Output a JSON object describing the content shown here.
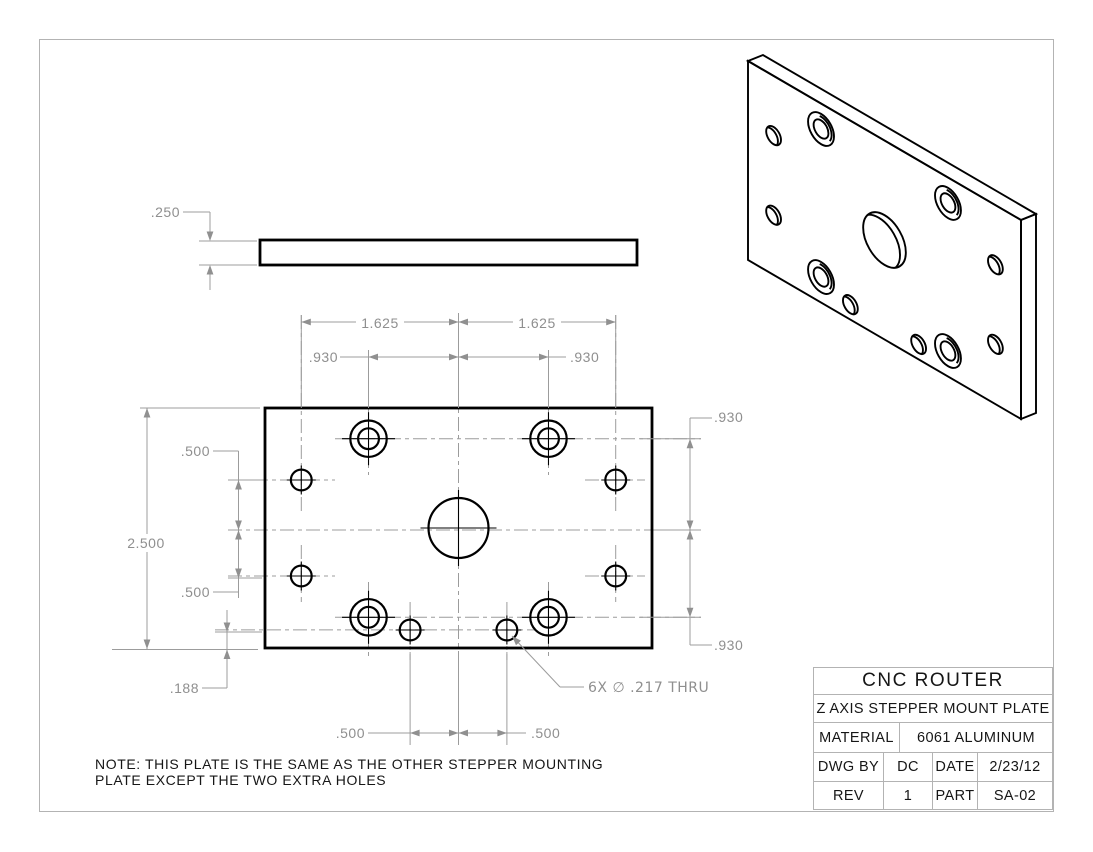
{
  "title_block": {
    "title": "CNC ROUTER",
    "subtitle": "Z AXIS STEPPER MOUNT PLATE",
    "material_label": "MATERIAL",
    "material_value": "6061 ALUMINUM",
    "dwg_by_label": "DWG BY",
    "dwg_by_value": "DC",
    "date_label": "DATE",
    "date_value": "2/23/12",
    "rev_label": "REV",
    "rev_value": "1",
    "part_label": "PART",
    "part_value": "SA-02"
  },
  "note": {
    "line1": "NOTE: THIS PLATE IS THE SAME AS THE OTHER STEPPER MOUNTING",
    "line2": "PLATE EXCEPT THE TWO EXTRA HOLES"
  },
  "dimensions": {
    "side_thickness": ".250",
    "top_left_1625": "1.625",
    "top_right_1625": "1.625",
    "upper_left_930": ".930",
    "upper_right_930": ".930",
    "right_top_930": ".930",
    "right_bottom_930": ".930",
    "left_top_500": ".500",
    "overall_height": "2.500",
    "left_bottom_500": ".500",
    "bottom_offset_188": ".188",
    "bottom_left_500": ".500",
    "bottom_right_500": ".500",
    "hole_callout": "6X ∅ .217 THRU"
  },
  "colors": {
    "geometry": "#000000",
    "dimension": "#9c9c9c",
    "dim_text": "#8f8f8f",
    "frame": "#b3b3b3"
  },
  "geometry": {
    "front": {
      "origin_x": 265,
      "origin_y": 408,
      "px_per_in_x": 96.75,
      "px_per_in_y": 96,
      "plate_w_in": 4.0,
      "plate_h_in": 2.5
    },
    "radii_in": {
      "small": 0.1085,
      "cbore_outer": 0.19,
      "cbore_inner": 0.1085,
      "center": 0.3125
    },
    "holes": [
      {
        "kind": "cbore",
        "x": 1.07,
        "y": 0.32
      },
      {
        "kind": "cbore",
        "x": 2.93,
        "y": 0.32
      },
      {
        "kind": "cbore",
        "x": 1.07,
        "y": 2.18
      },
      {
        "kind": "cbore",
        "x": 2.93,
        "y": 2.18
      },
      {
        "kind": "small",
        "x": 0.375,
        "y": 0.75
      },
      {
        "kind": "small",
        "x": 3.625,
        "y": 0.75
      },
      {
        "kind": "small",
        "x": 0.375,
        "y": 1.75
      },
      {
        "kind": "small",
        "x": 3.625,
        "y": 1.75
      },
      {
        "kind": "small",
        "x": 1.5,
        "y": 2.3125
      },
      {
        "kind": "small",
        "x": 2.5,
        "y": 2.3125
      },
      {
        "kind": "center",
        "x": 2.0,
        "y": 1.25
      }
    ],
    "iso": {
      "m": [
        68.25,
        39.75,
        0,
        79.6,
        748,
        61
      ],
      "thickness_px": [
        15,
        -6
      ]
    }
  }
}
